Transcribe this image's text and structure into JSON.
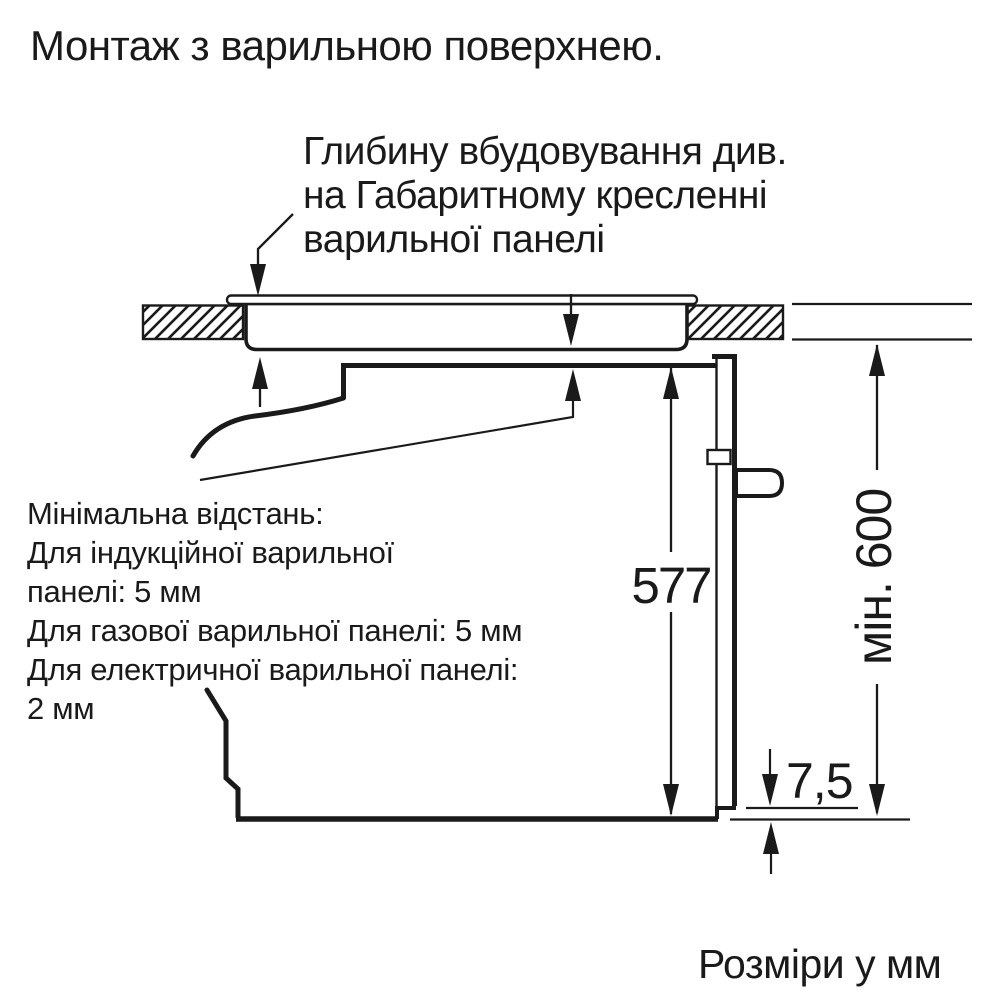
{
  "title": "Монтаж з варильною поверхнею.",
  "embedding_note": {
    "line1": "Глибину вбудовування див.",
    "line2": "на Габаритному кресленні",
    "line3": "варильної панелі"
  },
  "min_distance_note": {
    "line1": "Мінімальна відстань:",
    "line2": "Для індукційної варильної",
    "line3": "панелі: 5 мм",
    "line4": "Для газової варильної панелі: 5 мм",
    "line5": "Для електричної варильної панелі:",
    "line6": "2 мм"
  },
  "dimensions": {
    "oven_height": "577",
    "niche_height": "мін. 600",
    "bottom_gap": "7,5"
  },
  "footer": "Розміри у мм",
  "colors": {
    "ink": "#1a1a1a",
    "background": "#ffffff"
  }
}
